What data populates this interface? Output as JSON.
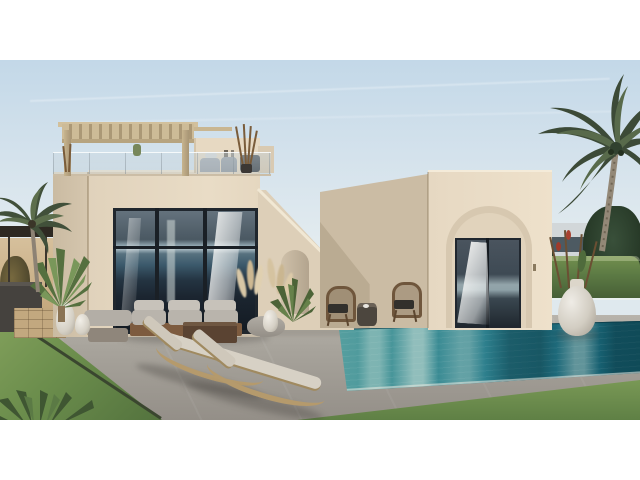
{
  "scene": {
    "type": "natural-image",
    "description": "Photorealistic exterior rendering of a modern two-volume sand-colored villa with rooftop pergola terrace, exterior staircase, arched doorway, floor-to-ceiling glazing, outdoor lounge furniture, two sun loungers, a turquoise swimming pool, lawns and palm trees under a pale blue sky, letterboxed on a white background",
    "elements": {
      "sky": {
        "label": "pale blue sky with faint contrails"
      },
      "main_villa": {
        "label": "two-storey beige villa volume with rooftop pergola terrace and glass railing"
      },
      "pergola": {
        "label": "wooden slatted pergola on roof terrace"
      },
      "stair": {
        "label": "exterior staircase wall with small arched passage"
      },
      "right_villa": {
        "label": "single-storey beige volume with recessed arch and glass sliding door"
      },
      "window": {
        "label": "floor-to-ceiling glazing reflecting the sea horizon, white curtains inside"
      },
      "pool": {
        "label": "turquoise infinity swimming pool with building reflections"
      },
      "deck": {
        "label": "wooden pool-side deck with two wicker armchairs and side table"
      },
      "loungers": {
        "label": "two curved wooden sun loungers with beige cushions"
      },
      "sofa": {
        "label": "outdoor sofa set with grey cushions, coffee table and pouf"
      },
      "urn": {
        "label": "large white textured urn with dry flowering branches"
      },
      "palms": {
        "label": "coconut palm trees left and right"
      },
      "lawn": {
        "label": "green lawn areas with agave plants"
      },
      "neighbour": {
        "label": "neighbouring structure with dark canopy, barbecue counter, stone wall and white jars"
      }
    }
  },
  "palette": {
    "letterbox": "#ffffff",
    "sky_top": "#c3d8e8",
    "sky_horizon": "#e9efef",
    "facade_light": "#e9dcc6",
    "facade_shadow": "#cbbca4",
    "glass_dark": "#20272e",
    "horizon_reflection": "#a9bac2",
    "pool_light": "#58a0a0",
    "pool_deep": "#135b6b",
    "patio_grey": "#a8a49c",
    "lawn_green": "#6b8d4c",
    "wood_tan": "#c9ae80",
    "pergola_wood": "#cdbb97",
    "hedge_green": "#5c7a44"
  }
}
